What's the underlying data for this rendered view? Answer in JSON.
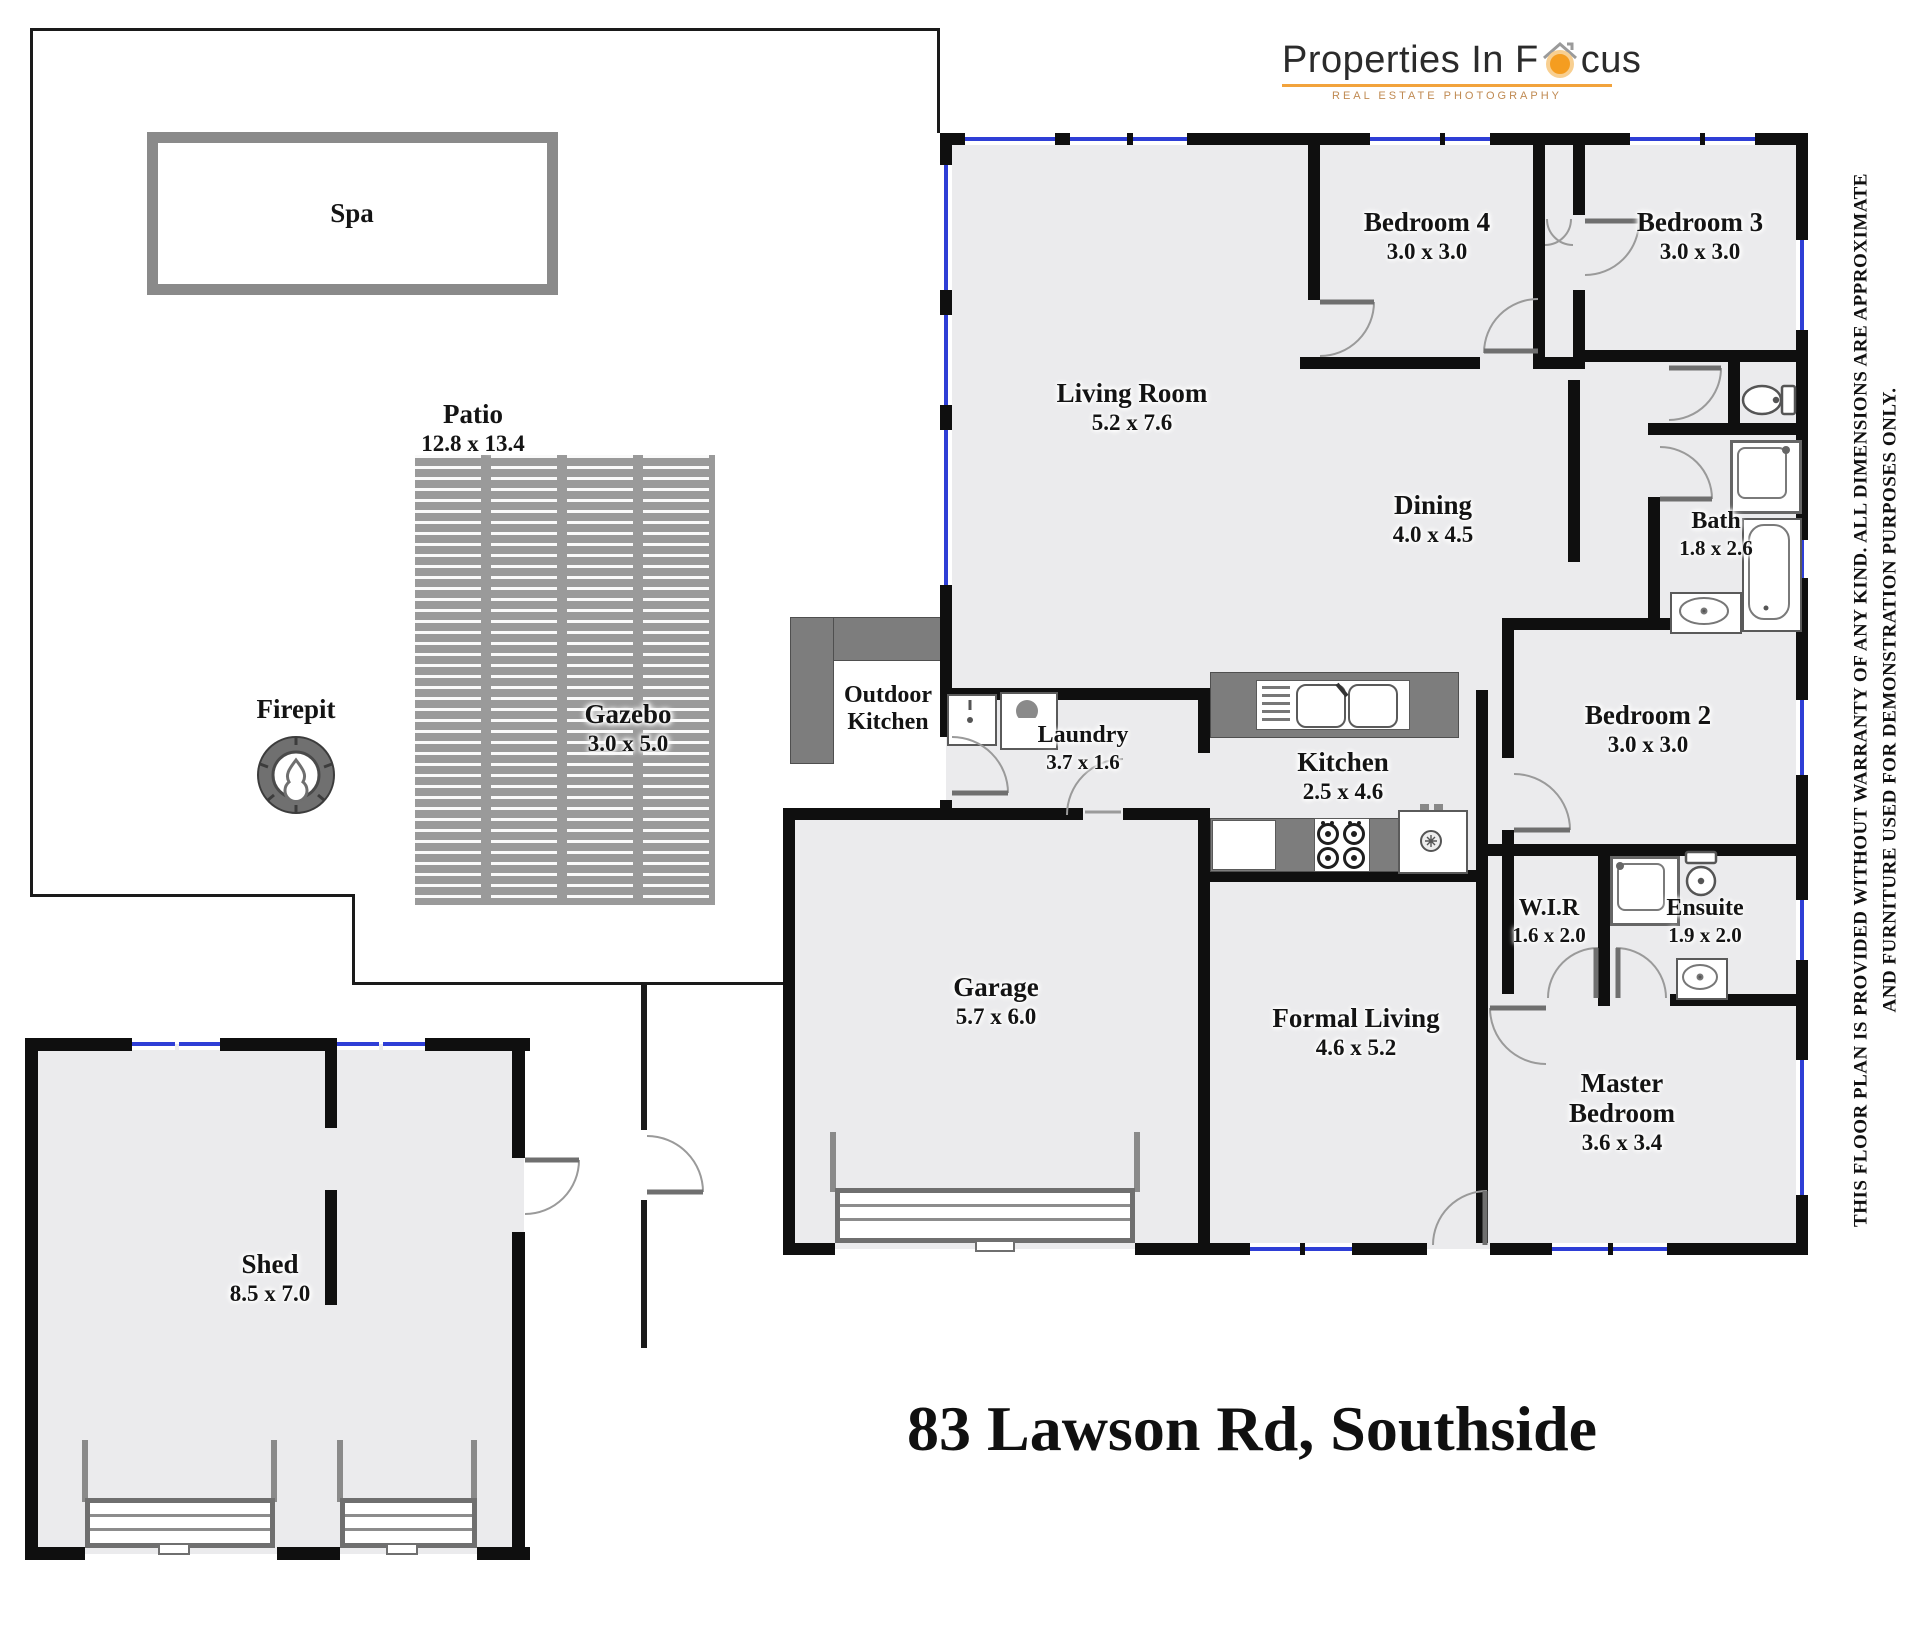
{
  "brand": {
    "logo_text_pre": "Properties In F",
    "logo_text_post": "cus",
    "tagline": "REAL ESTATE PHOTOGRAPHY",
    "accent_color": "#f2a33c"
  },
  "title": "83 Lawson Rd, Southside",
  "disclaimer": {
    "line1": "THIS FLOOR PLAN IS PROVIDED WITHOUT WARRANTY OF ANY KIND. ALL DIMENSIONS ARE APPROXIMATE",
    "line2": "AND FURNITURE USED FOR DEMONSTRATION PURPOSES ONLY."
  },
  "colors": {
    "wall": "#0f0f0f",
    "floor": "#ebebed",
    "window": "#2e3ed6",
    "counter": "#7d7d7d"
  },
  "rooms": {
    "spa": {
      "name": "Spa",
      "dims": ""
    },
    "patio": {
      "name": "Patio",
      "dims": "12.8 x 13.4"
    },
    "firepit": {
      "name": "Firepit",
      "dims": ""
    },
    "gazebo": {
      "name": "Gazebo",
      "dims": "3.0 x 5.0"
    },
    "outdoor_kitchen": {
      "name": "Outdoor Kitchen",
      "dims": ""
    },
    "living": {
      "name": "Living Room",
      "dims": "5.2 x 7.6"
    },
    "dining": {
      "name": "Dining",
      "dims": "4.0 x 4.5"
    },
    "bedroom4": {
      "name": "Bedroom 4",
      "dims": "3.0 x 3.0"
    },
    "bedroom3": {
      "name": "Bedroom 3",
      "dims": "3.0 x 3.0"
    },
    "bath": {
      "name": "Bath",
      "dims": "1.8 x 2.6"
    },
    "bedroom2": {
      "name": "Bedroom 2",
      "dims": "3.0 x 3.0"
    },
    "laundry": {
      "name": "Laundry",
      "dims": "3.7 x 1.6"
    },
    "kitchen": {
      "name": "Kitchen",
      "dims": "2.5 x 4.6"
    },
    "garage": {
      "name": "Garage",
      "dims": "5.7 x 6.0"
    },
    "formal_living": {
      "name": "Formal Living",
      "dims": "4.6 x 5.2"
    },
    "wir": {
      "name": "W.I.R",
      "dims": "1.6 x 2.0"
    },
    "ensuite": {
      "name": "Ensuite",
      "dims": "1.9 x 2.0"
    },
    "master": {
      "name": "Master Bedroom",
      "dims": "3.6 x 3.4"
    },
    "shed": {
      "name": "Shed",
      "dims": "8.5 x 7.0"
    }
  }
}
